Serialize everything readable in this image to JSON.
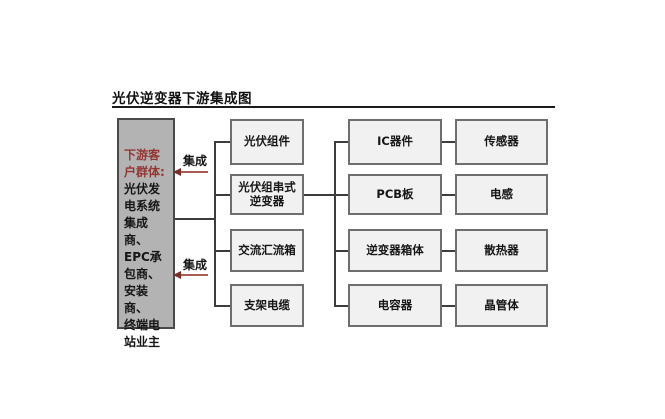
{
  "title": "光伏逆变器下游集成图",
  "customer_box": {
    "heading": "下游客\n户群体:",
    "body": "光伏发\n电系统\n集成商、\nEPC承\n包商、\n安装商、\n终端电\n站业主"
  },
  "integration": {
    "top_label": "集成",
    "bottom_label": "集成"
  },
  "columns": [
    {
      "name": "pv-system-parts",
      "nodes": [
        "光伏组件",
        "光伏组串式\n逆变器",
        "交流汇流箱",
        "支架电缆"
      ]
    },
    {
      "name": "inverter-components",
      "nodes": [
        "IC器件",
        "PCB板",
        "逆变器箱体",
        "电容器"
      ]
    },
    {
      "name": "sub-components",
      "nodes": [
        "传感器",
        "电感",
        "散热器",
        "晶管体"
      ]
    }
  ],
  "colors": {
    "accent_red": "#943634",
    "arrow_line": "#a85d55",
    "customer_box_fill": "#b3b3b3",
    "node_fill": "#f0f1f0",
    "node_border": "#6e6e6e",
    "connector": "#3d3d3d"
  }
}
